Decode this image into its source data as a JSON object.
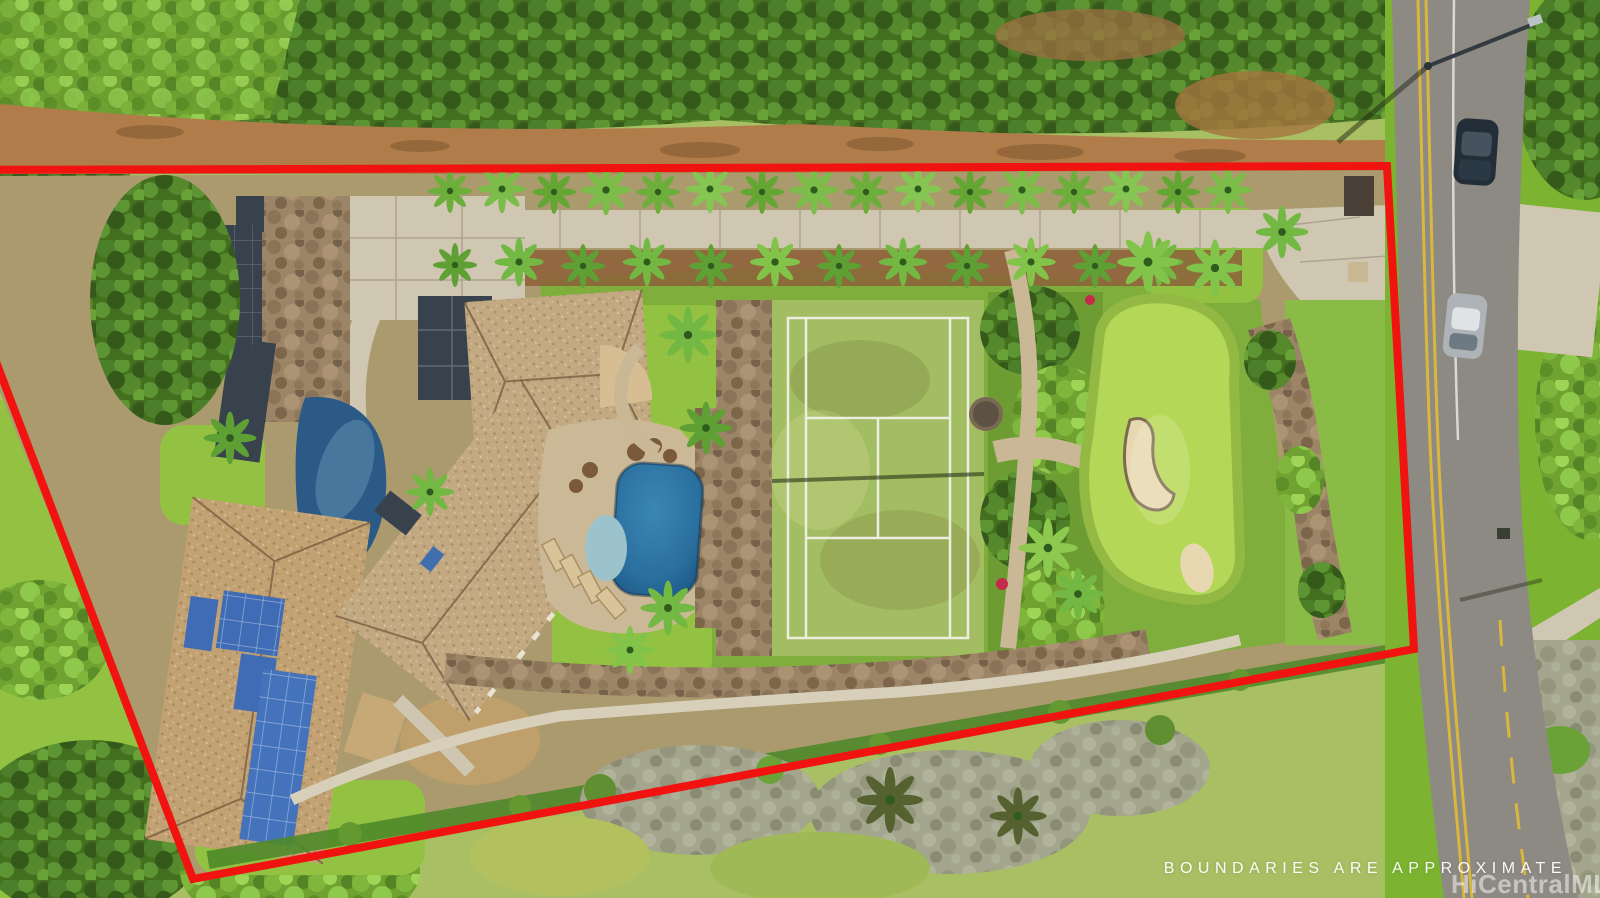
{
  "page": {
    "kind": "real-estate aerial listing photograph",
    "width_px": 1600,
    "height_px": 898
  },
  "overlay": {
    "disclaimer_text": "BOUNDARIES ARE APPROXIMATE",
    "watermark_text": "HiCentralMLS"
  },
  "scene": {
    "features": [
      "tree-canopy-strip",
      "dirt-access-road",
      "red-boundary-outline",
      "palm-lined-driveway",
      "entrance-apron",
      "motor-court",
      "ground-solar-array",
      "pond",
      "main-house-roof",
      "guest-house-roof",
      "rooftop-solar-panels",
      "skylights",
      "swimming-pool",
      "spa",
      "pool-deck",
      "lounge-chairs",
      "waterfall-rocks",
      "tennis-court",
      "tennis-net-shadow",
      "tropical-garden",
      "garden-fountain",
      "stone-path",
      "putting-green",
      "sand-bunkers",
      "rock-walls",
      "perimeter-walkway",
      "hedge-row",
      "scrubland",
      "street",
      "double-yellow-line",
      "street-light",
      "parked-suv",
      "parked-sedan",
      "sidewalk-pads",
      "grass-verge"
    ]
  },
  "palette": {
    "boundary": "#f01310",
    "forest": "#477522",
    "dirt": "#b07c49",
    "lawn": "#93c243",
    "scrub": "#a9bf63",
    "concrete": "#d0c7b3",
    "asphalt": "#8d8983",
    "road_yellow": "#d9b73c",
    "roof_tan": "#c3a981",
    "roof_guest": "#c2a172",
    "solar_blue": "#3f6cb4",
    "solar_dark": "#38424d",
    "pool_water": "#2a6f9e",
    "spa_water": "#9cc3cb",
    "pond_water": "#2a5a85",
    "court_green": "#a3bd62",
    "putting_green": "#b5d757",
    "sand": "#e7d8b2",
    "stone": "#9b8466",
    "grass_verge": "#7cb431"
  }
}
